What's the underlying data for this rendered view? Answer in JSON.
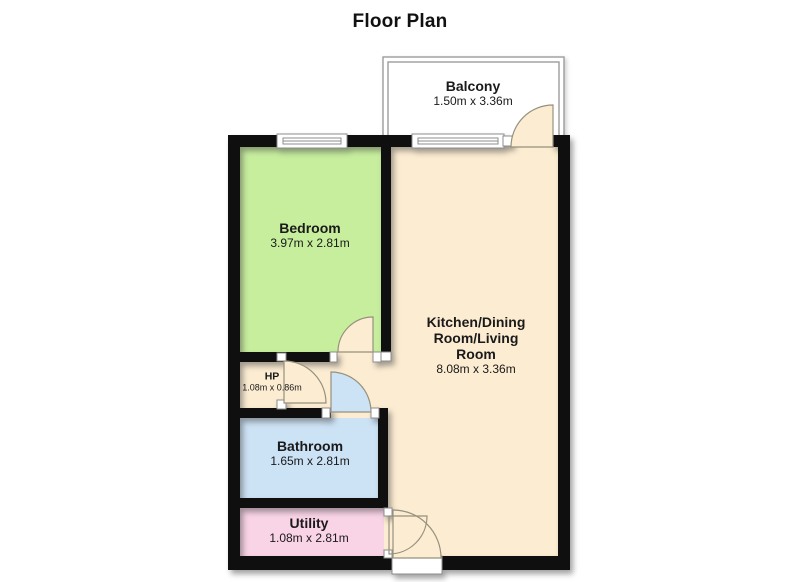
{
  "title": "Floor Plan",
  "rooms": {
    "balcony": {
      "name": "Balcony",
      "dims": "1.50m x 3.36m",
      "color": "#ffffff"
    },
    "bedroom": {
      "name": "Bedroom",
      "dims": "3.97m x 2.81m",
      "color": "#c6ee9d"
    },
    "kitchen": {
      "name": "Kitchen/Dining Room/Living Room",
      "dims": "8.08m x 3.36m",
      "color": "#fcecd2"
    },
    "hp": {
      "name": "HP",
      "dims": "1.08m x 0.86m",
      "color": "#fcecd2"
    },
    "bathroom": {
      "name": "Bathroom",
      "dims": "1.65m x 2.81m",
      "color": "#cce2f5"
    },
    "utility": {
      "name": "Utility",
      "dims": "1.08m x 2.81m",
      "color": "#f9d3e6"
    }
  },
  "palette": {
    "wall": "#0f0f0f",
    "door_stroke": "#96917e",
    "frame_stroke": "#8c8c8c",
    "rail_stroke": "#9c9c9c",
    "text": "#1a1a1a"
  }
}
